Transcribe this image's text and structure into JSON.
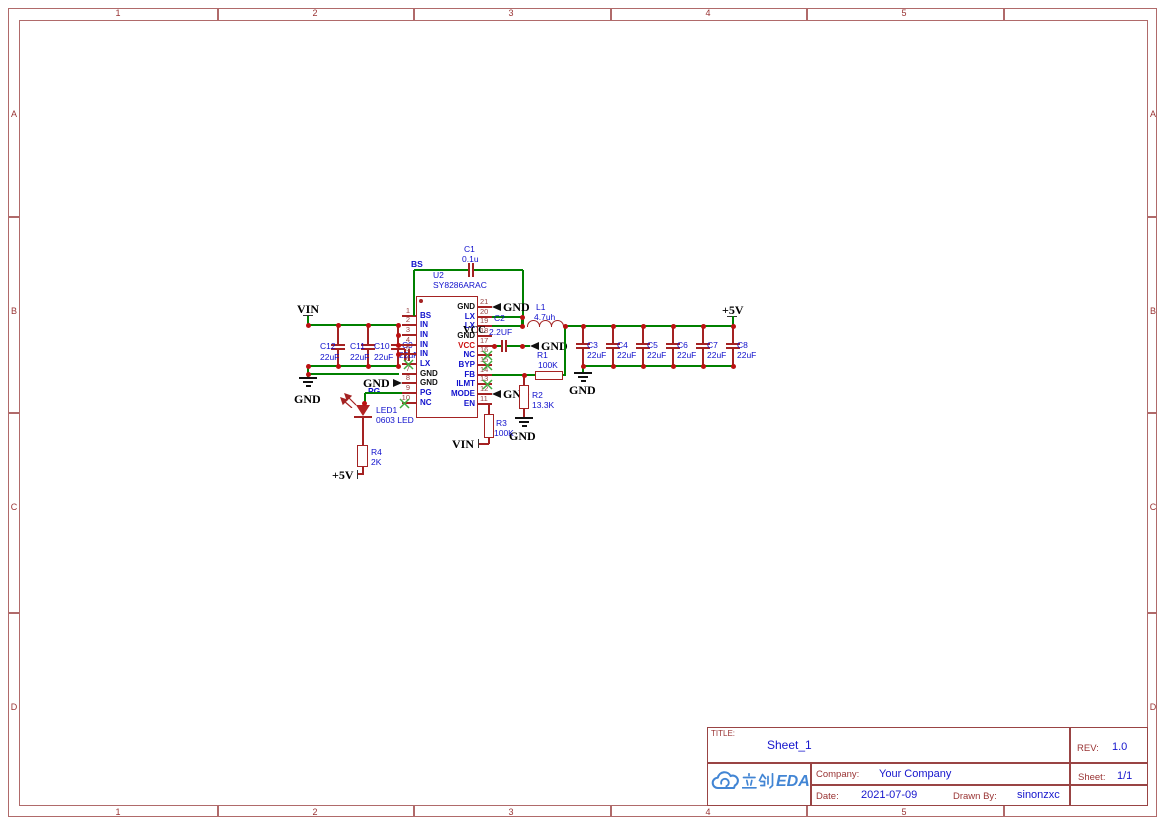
{
  "frame": {
    "columns": [
      "1",
      "2",
      "3",
      "4",
      "5"
    ],
    "rows": [
      "A",
      "B",
      "C",
      "D"
    ]
  },
  "title_block": {
    "title_label": "TITLE:",
    "title": "Sheet_1",
    "rev_label": "REV:",
    "rev": "1.0",
    "company_label": "Company:",
    "company": "Your Company",
    "sheet_label": "Sheet:",
    "sheet": "1/1",
    "date_label": "Date:",
    "date": "2021-07-09",
    "drawn_by_label": "Drawn By:",
    "drawn_by": "sinonzxc",
    "logo_text": "立创EDA",
    "logo_text_latin": "EDA",
    "logo_color": "#4285d4"
  },
  "colors": {
    "wire": "#008000",
    "symbol": "#a42222",
    "junction": "#bb1111",
    "designator_text": "#1010cc",
    "pin_number_text": "#994444",
    "net_label_text": "#000000",
    "frame_line": "#b06a6a",
    "no_connect_x": "#3fae3f"
  },
  "ic": {
    "ref": "U2",
    "part": "SY8286ARAC",
    "left_pins": [
      {
        "num": "1",
        "name": "BS"
      },
      {
        "num": "2",
        "name": "IN"
      },
      {
        "num": "3",
        "name": "IN"
      },
      {
        "num": "4",
        "name": "IN"
      },
      {
        "num": "5",
        "name": "IN"
      },
      {
        "num": "6",
        "name": "LX"
      },
      {
        "num": "7",
        "name": "GND"
      },
      {
        "num": "8",
        "name": "GND"
      },
      {
        "num": "9",
        "name": "PG"
      },
      {
        "num": "10",
        "name": "NC"
      }
    ],
    "right_pins": [
      {
        "num": "21",
        "name": "GND"
      },
      {
        "num": "20",
        "name": "LX"
      },
      {
        "num": "19",
        "name": "LX"
      },
      {
        "num": "18",
        "name": "GND"
      },
      {
        "num": "17",
        "name": "VCC"
      },
      {
        "num": "16",
        "name": "NC"
      },
      {
        "num": "15",
        "name": "BYP"
      },
      {
        "num": "14",
        "name": "FB"
      },
      {
        "num": "13",
        "name": "ILMT"
      },
      {
        "num": "12",
        "name": "MODE"
      },
      {
        "num": "11",
        "name": "EN"
      }
    ]
  },
  "components": {
    "c1": {
      "ref": "C1",
      "value": "0.1u"
    },
    "c2": {
      "ref": "C2",
      "value": "2.2UF"
    },
    "c9": {
      "ref": "C9",
      "value": "22uF"
    },
    "l1": {
      "ref": "L1",
      "value": "4.7uh"
    },
    "r1": {
      "ref": "R1",
      "value": "100K"
    },
    "r2": {
      "ref": "R2",
      "value": "13.3K"
    },
    "r3": {
      "ref": "R3",
      "value": "100K"
    },
    "r4": {
      "ref": "R4",
      "value": "2K"
    },
    "led1": {
      "ref": "LED1",
      "value": "0603 LED"
    },
    "input_caps": [
      {
        "ref": "C12",
        "value": "22uF"
      },
      {
        "ref": "C11",
        "value": "22uF"
      },
      {
        "ref": "C10",
        "value": "22uF"
      }
    ],
    "output_caps": [
      {
        "ref": "C3",
        "value": "22uF"
      },
      {
        "ref": "C4",
        "value": "22uF"
      },
      {
        "ref": "C5",
        "value": "22uF"
      },
      {
        "ref": "C6",
        "value": "22uF"
      },
      {
        "ref": "C7",
        "value": "22uF"
      },
      {
        "ref": "C8",
        "value": "22uF"
      }
    ]
  },
  "net_labels": {
    "vin": "VIN",
    "gnd": "GND",
    "p5v": "+5V",
    "vcc": "VCC",
    "bs": "BS",
    "pg": "PG"
  }
}
